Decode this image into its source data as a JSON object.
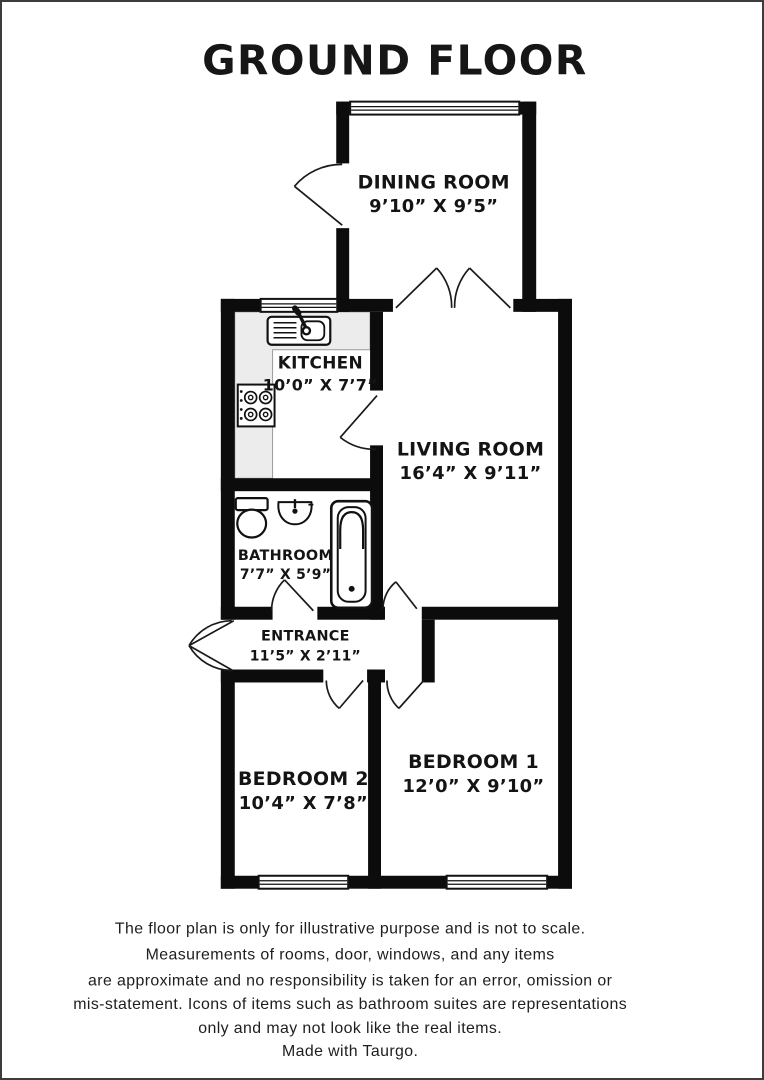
{
  "title": "GROUND FLOOR",
  "rooms": {
    "dining": {
      "name": "DINING ROOM",
      "dims": "9’10” X 9’5”"
    },
    "kitchen": {
      "name": "KITCHEN",
      "dims": "10’0” X 7’7”"
    },
    "living": {
      "name": "LIVING ROOM",
      "dims": "16’4” X 9’11”"
    },
    "bathroom": {
      "name": "BATHROOM",
      "dims": "7’7” X 5’9”"
    },
    "entrance": {
      "name": "ENTRANCE",
      "dims": "11’5” X 2’11”"
    },
    "bedroom2": {
      "name": "BEDROOM 2",
      "dims": "10’4” X 7’8”"
    },
    "bedroom1": {
      "name": "BEDROOM 1",
      "dims": "12’0” X 9’10”"
    }
  },
  "icons": [
    "sink-icon",
    "hob-icon",
    "toilet-icon",
    "basin-icon",
    "bathtub-icon"
  ],
  "colors": {
    "wall": "#0c0c0c",
    "counter": "#ececec",
    "page_border": "#3c3c3c",
    "text": "#141414"
  },
  "disclaimer": {
    "line1": "The floor plan is only for illustrative purpose and is not to scale.",
    "line2": "Measurements of rooms, door, windows, and any items",
    "line3": "are approximate and no responsibility is taken for an error, omission or",
    "line4": "mis-statement. Icons of items such as bathroom suites are representations",
    "line5": "only and may not look like the real items.",
    "line6": "Made with Taurgo."
  }
}
